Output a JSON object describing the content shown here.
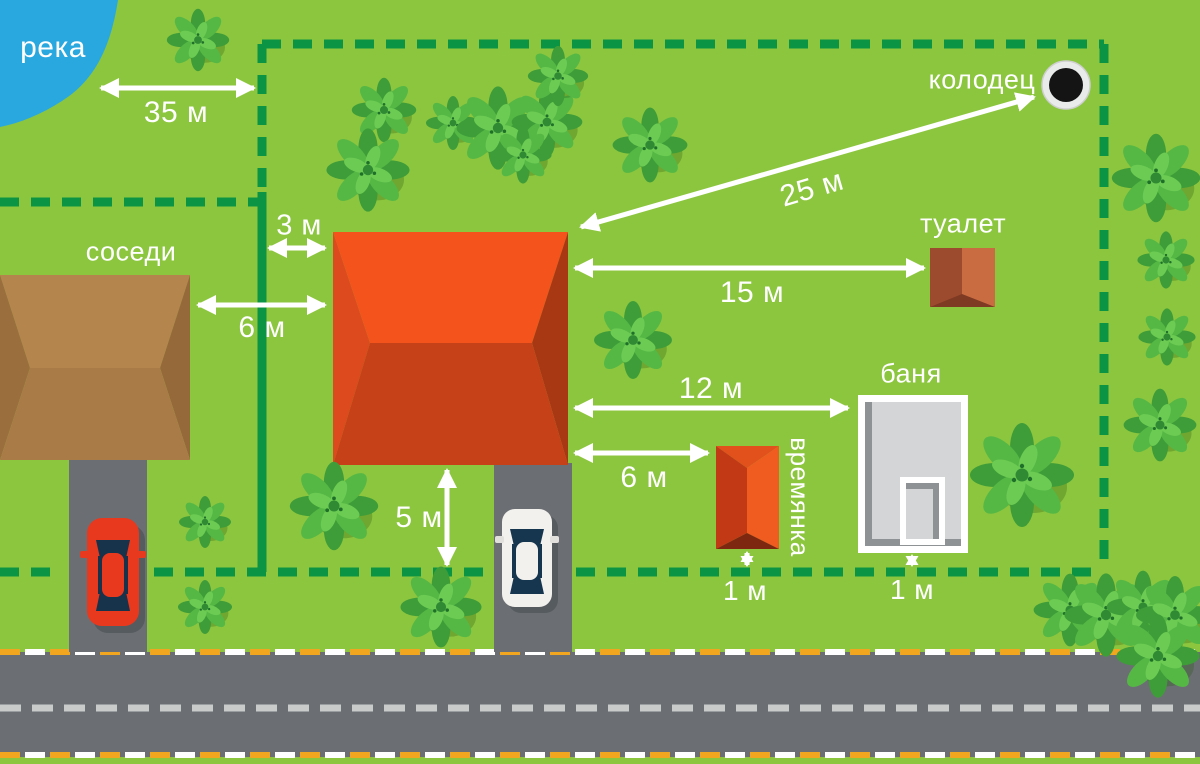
{
  "labels": {
    "river": "река",
    "neighbors": "соседи",
    "well": "колодец",
    "toilet": "туалет",
    "bathhouse": "баня",
    "shed": "времянка"
  },
  "distances": {
    "river_to_boundary": "35 м",
    "boundary_to_house": "3 м",
    "neighbor_house_to_house": "6 м",
    "house_to_well": "25 м",
    "house_to_toilet": "15 м",
    "house_to_bathhouse": "12 м",
    "house_to_shed": "6 м",
    "house_to_front_boundary": "5 м",
    "shed_to_boundary": "1 м",
    "bathhouse_to_boundary": "1 м"
  },
  "icons": {
    "well": "well-icon",
    "bush": "bush-icon"
  },
  "colors": {
    "grass": "#8CC63E",
    "boundary_green": "#0B9444",
    "river_blue": "#29A8E0",
    "road_gray": "#6B6F73",
    "house_roof_orange": "#F4541C",
    "neighbor_roof_brown": "#B5854E",
    "road_edge_orange": "#F2A51F",
    "arrow_white": "#FFFFFF"
  }
}
